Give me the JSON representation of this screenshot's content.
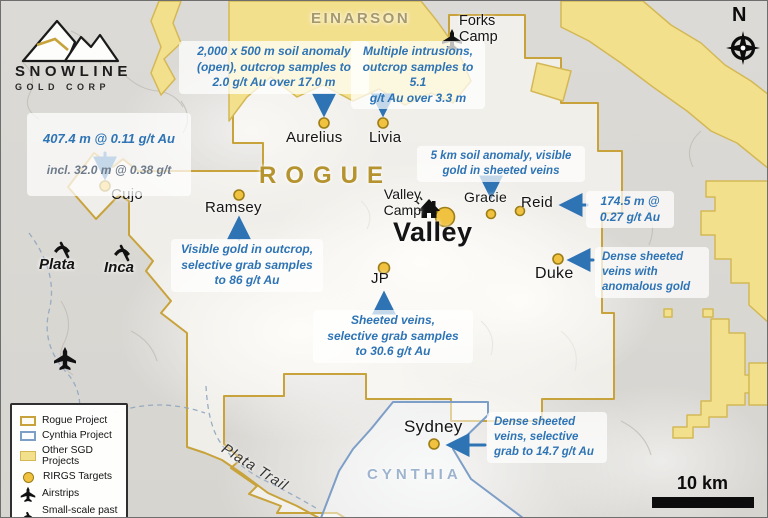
{
  "colors": {
    "annotation_blue": "#2e74b5",
    "rogue_border_gold": "#c8a23b",
    "sgd_yellow": "#f3e08d",
    "cynthia_blue": "#7d9ec6",
    "target_dot": "#f0c23f",
    "rogue_label": "#b5932f",
    "einarson_label": "#a5986c",
    "cynthia_label": "#9db3ce"
  },
  "brand": {
    "name": "SNOWLINE",
    "subtitle": "GOLD CORP"
  },
  "regions": {
    "einarson": "EINARSON",
    "rogue": "ROGUE",
    "cynthia": "CYNTHIA",
    "plata_trail": "Plata Trail"
  },
  "camps": {
    "forks": "Forks\nCamp",
    "valley": "Valley\nCamp"
  },
  "targets": [
    {
      "name": "Cujo"
    },
    {
      "name": "Ramsey"
    },
    {
      "name": "Aurelius"
    },
    {
      "name": "Livia"
    },
    {
      "name": "Valley"
    },
    {
      "name": "Gracie"
    },
    {
      "name": "Reid"
    },
    {
      "name": "Duke"
    },
    {
      "name": "JP"
    },
    {
      "name": "Sydney"
    }
  ],
  "past_producers": [
    {
      "name": "Plata"
    },
    {
      "name": "Inca"
    }
  ],
  "annotations": [
    {
      "line1": "407.4 m @ 0.11 g/t Au",
      "line2": "incl. 32.0 m @ 0.38 g/t"
    },
    {
      "text": "2,000 x 500 m soil anomaly\n(open), outcrop samples to\n2.0 g/t Au over 17.0 m"
    },
    {
      "text": "Multiple intrusions,\noutcrop samples to 5.1\ng/t Au over 3.3 m"
    },
    {
      "text": "5 km soil anomaly, visible\ngold in sheeted veins"
    },
    {
      "text": "174.5 m @\n0.27 g/t Au"
    },
    {
      "text": "Dense sheeted\nveins with\nanomalous gold"
    },
    {
      "text": "Visible gold in outcrop,\nselective grab samples\nto 86 g/t Au"
    },
    {
      "text": "Sheeted veins,\nselective grab samples\nto 30.6 g/t Au"
    },
    {
      "text": "Dense sheeted\nveins, selective\ngrab to 14.7 g/t Au"
    }
  ],
  "legend": {
    "items": [
      {
        "label": "Rogue Project"
      },
      {
        "label": "Cynthia Project"
      },
      {
        "label": "Other SGD Projects"
      },
      {
        "label": "RIRGS Targets"
      },
      {
        "label": "Airstrips"
      },
      {
        "label": "Small-scale past\nproducers (Ag)"
      }
    ]
  },
  "compass": {
    "label": "N"
  },
  "scale_bar": {
    "label": "10 km"
  }
}
